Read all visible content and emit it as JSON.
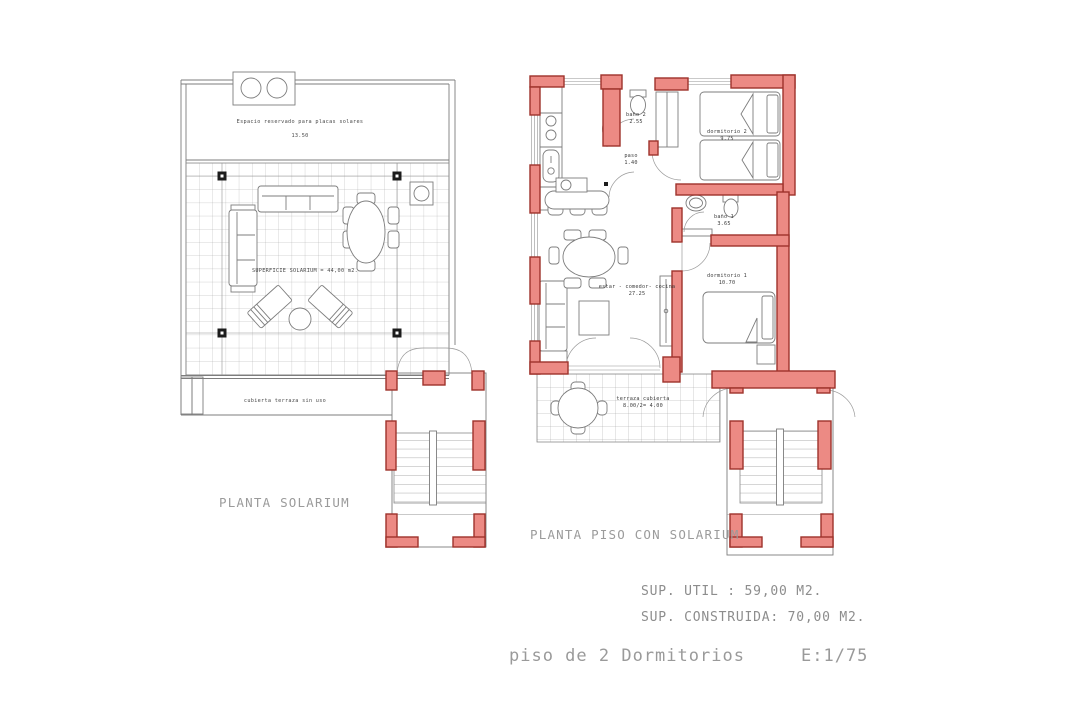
{
  "colors": {
    "wall_fill": "#ec8a84",
    "wall_stroke": "#9e322b",
    "drawing_line": "#7d7d7d",
    "title_gray": "#9b9b9b"
  },
  "solarium": {
    "title": "PLANTA SOLARIUM",
    "reserved_note": "Espacio reservado para placas solares",
    "reserved_value": "13.50",
    "surface_label": "SUPERFICIE SOLARIUM = 44,00 m2.",
    "roof_note": "cubierta terraza sin uso"
  },
  "piso": {
    "title": "PLANTA PISO CON SOLARIUM",
    "rooms": {
      "bano2": {
        "name": "baño 2",
        "area": "2.55"
      },
      "dormitorio2": {
        "name": "dormitorio 2",
        "area": "9.75"
      },
      "paso": {
        "name": "paso",
        "area": "1.40"
      },
      "bano1": {
        "name": "baño 1",
        "area": "3.65"
      },
      "dormitorio1": {
        "name": "dormitorio 1",
        "area": "10.70"
      },
      "estar": {
        "name": "estar - comedor- cocina",
        "area": "27.25"
      },
      "terraza": {
        "name": "terraza cubierta",
        "area": "8.00/2= 4.00"
      }
    }
  },
  "summary": {
    "util": "SUP. UTIL : 59,00 M2.",
    "construida": "SUP. CONSTRUIDA: 70,00 M2."
  },
  "footer": {
    "title": "piso de 2 Dormitorios",
    "scale": "E:1/75"
  }
}
